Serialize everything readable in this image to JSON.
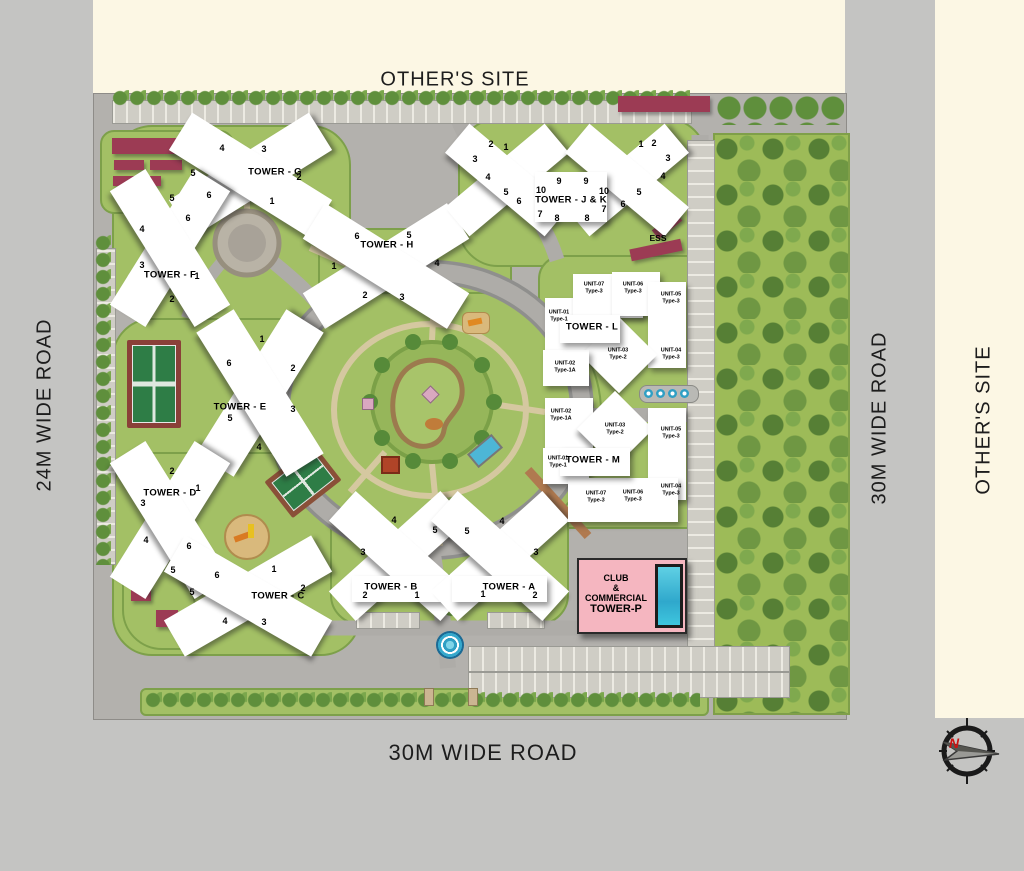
{
  "labels": {
    "top_site": "OTHER'S SITE",
    "left_road": "24M WIDE ROAD",
    "right_road": "30M WIDE ROAD",
    "right_site": "OTHER'S SITE",
    "bottom_road": "30M WIDE ROAD",
    "ess": "ESS",
    "compass_north": "N"
  },
  "towers": {
    "g": {
      "label": "TOWER - G",
      "numbers": [
        "4",
        "3",
        "5",
        "2",
        "6",
        "1"
      ]
    },
    "f": {
      "label": "TOWER - F",
      "numbers": [
        "5",
        "6",
        "4",
        "3",
        "1",
        "2"
      ]
    },
    "h": {
      "label": "TOWER - H",
      "numbers": [
        "6",
        "5",
        "1",
        "4",
        "2",
        "3"
      ]
    },
    "jk": {
      "label": "TOWER - J & K",
      "numbers_left": [
        "2",
        "1",
        "3",
        "4",
        "5",
        "6",
        "10",
        "9",
        "7",
        "8"
      ],
      "numbers_right": [
        "1",
        "2",
        "3",
        "4",
        "5",
        "6",
        "9",
        "10",
        "7",
        "8"
      ]
    },
    "e": {
      "label": "TOWER - E",
      "numbers": [
        "1",
        "6",
        "2",
        "3",
        "5",
        "4"
      ]
    },
    "d": {
      "label": "TOWER - D",
      "numbers": [
        "2",
        "1",
        "3",
        "4",
        "6",
        "5"
      ]
    },
    "c": {
      "label": "TOWER - C",
      "numbers": [
        "1",
        "2",
        "6",
        "5",
        "4",
        "3"
      ]
    },
    "b": {
      "label": "TOWER - B",
      "numbers": [
        "4",
        "5",
        "3",
        "2",
        "1"
      ]
    },
    "a": {
      "label": "TOWER - A",
      "numbers": [
        "5",
        "4",
        "3",
        "1",
        "2"
      ]
    },
    "l": {
      "label": "TOWER - L",
      "units": [
        {
          "name": "UNIT-07",
          "type": "Type-3"
        },
        {
          "name": "UNIT-06",
          "type": "Type-3"
        },
        {
          "name": "UNIT-05",
          "type": "Type-3"
        },
        {
          "name": "UNIT-01",
          "type": "Type-1"
        },
        {
          "name": "UNIT-03",
          "type": "Type-2"
        },
        {
          "name": "UNIT-04",
          "type": "Type-3"
        },
        {
          "name": "UNIT-02",
          "type": "Type-1A"
        }
      ]
    },
    "m": {
      "label": "TOWER - M",
      "units": [
        {
          "name": "UNIT-02",
          "type": "Type-1A"
        },
        {
          "name": "UNIT-03",
          "type": "Type-2"
        },
        {
          "name": "UNIT-05",
          "type": "Type-3"
        },
        {
          "name": "UNIT-01",
          "type": "Type-1"
        },
        {
          "name": "UNIT-04",
          "type": "Type-3"
        },
        {
          "name": "UNIT-07",
          "type": "Type-3"
        },
        {
          "name": "UNIT-06",
          "type": "Type-3"
        }
      ]
    },
    "p": {
      "line1": "CLUB",
      "line2": "&",
      "line3": "COMMERCIAL",
      "line4": "TOWER-P"
    }
  },
  "colors": {
    "cream": "#fcf7e4",
    "road_gray": "#c4c4c2",
    "site_gray": "#b3b1ad",
    "green": "#a3c065",
    "forest_green": "#9dbb58",
    "maroon": "#9c3b54",
    "club_pink": "#f5b6c0",
    "pool_blue": "#3ec6de",
    "court_green": "#2e7d46",
    "compass_n_red": "#cc1111"
  }
}
